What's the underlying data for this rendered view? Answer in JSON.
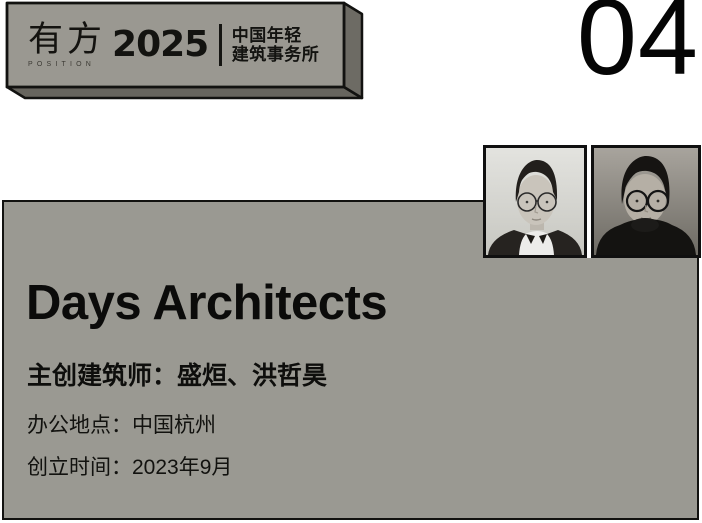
{
  "page_number": "04",
  "banner": {
    "brand_zh": "有方",
    "brand_en": "POSITION",
    "year": "2025",
    "subtitle_line1": "中国年轻",
    "subtitle_line2": "建筑事务所"
  },
  "card": {
    "firm_name": "Days Architects",
    "architects_line": "主创建筑师：盛烜、洪哲昊",
    "location_line": "办公地点：中国杭州",
    "founded_line": "创立时间：2023年9月"
  },
  "images": [
    "portrait-photo-left",
    "portrait-photo-right"
  ],
  "colors": {
    "card_gray": "#9a9992",
    "banner_face_gray": "#9a9891",
    "banner_side_gray": "#67655e",
    "outline_black": "#121210",
    "text_black": "#0d0d0d",
    "background_white": "#ffffff"
  }
}
